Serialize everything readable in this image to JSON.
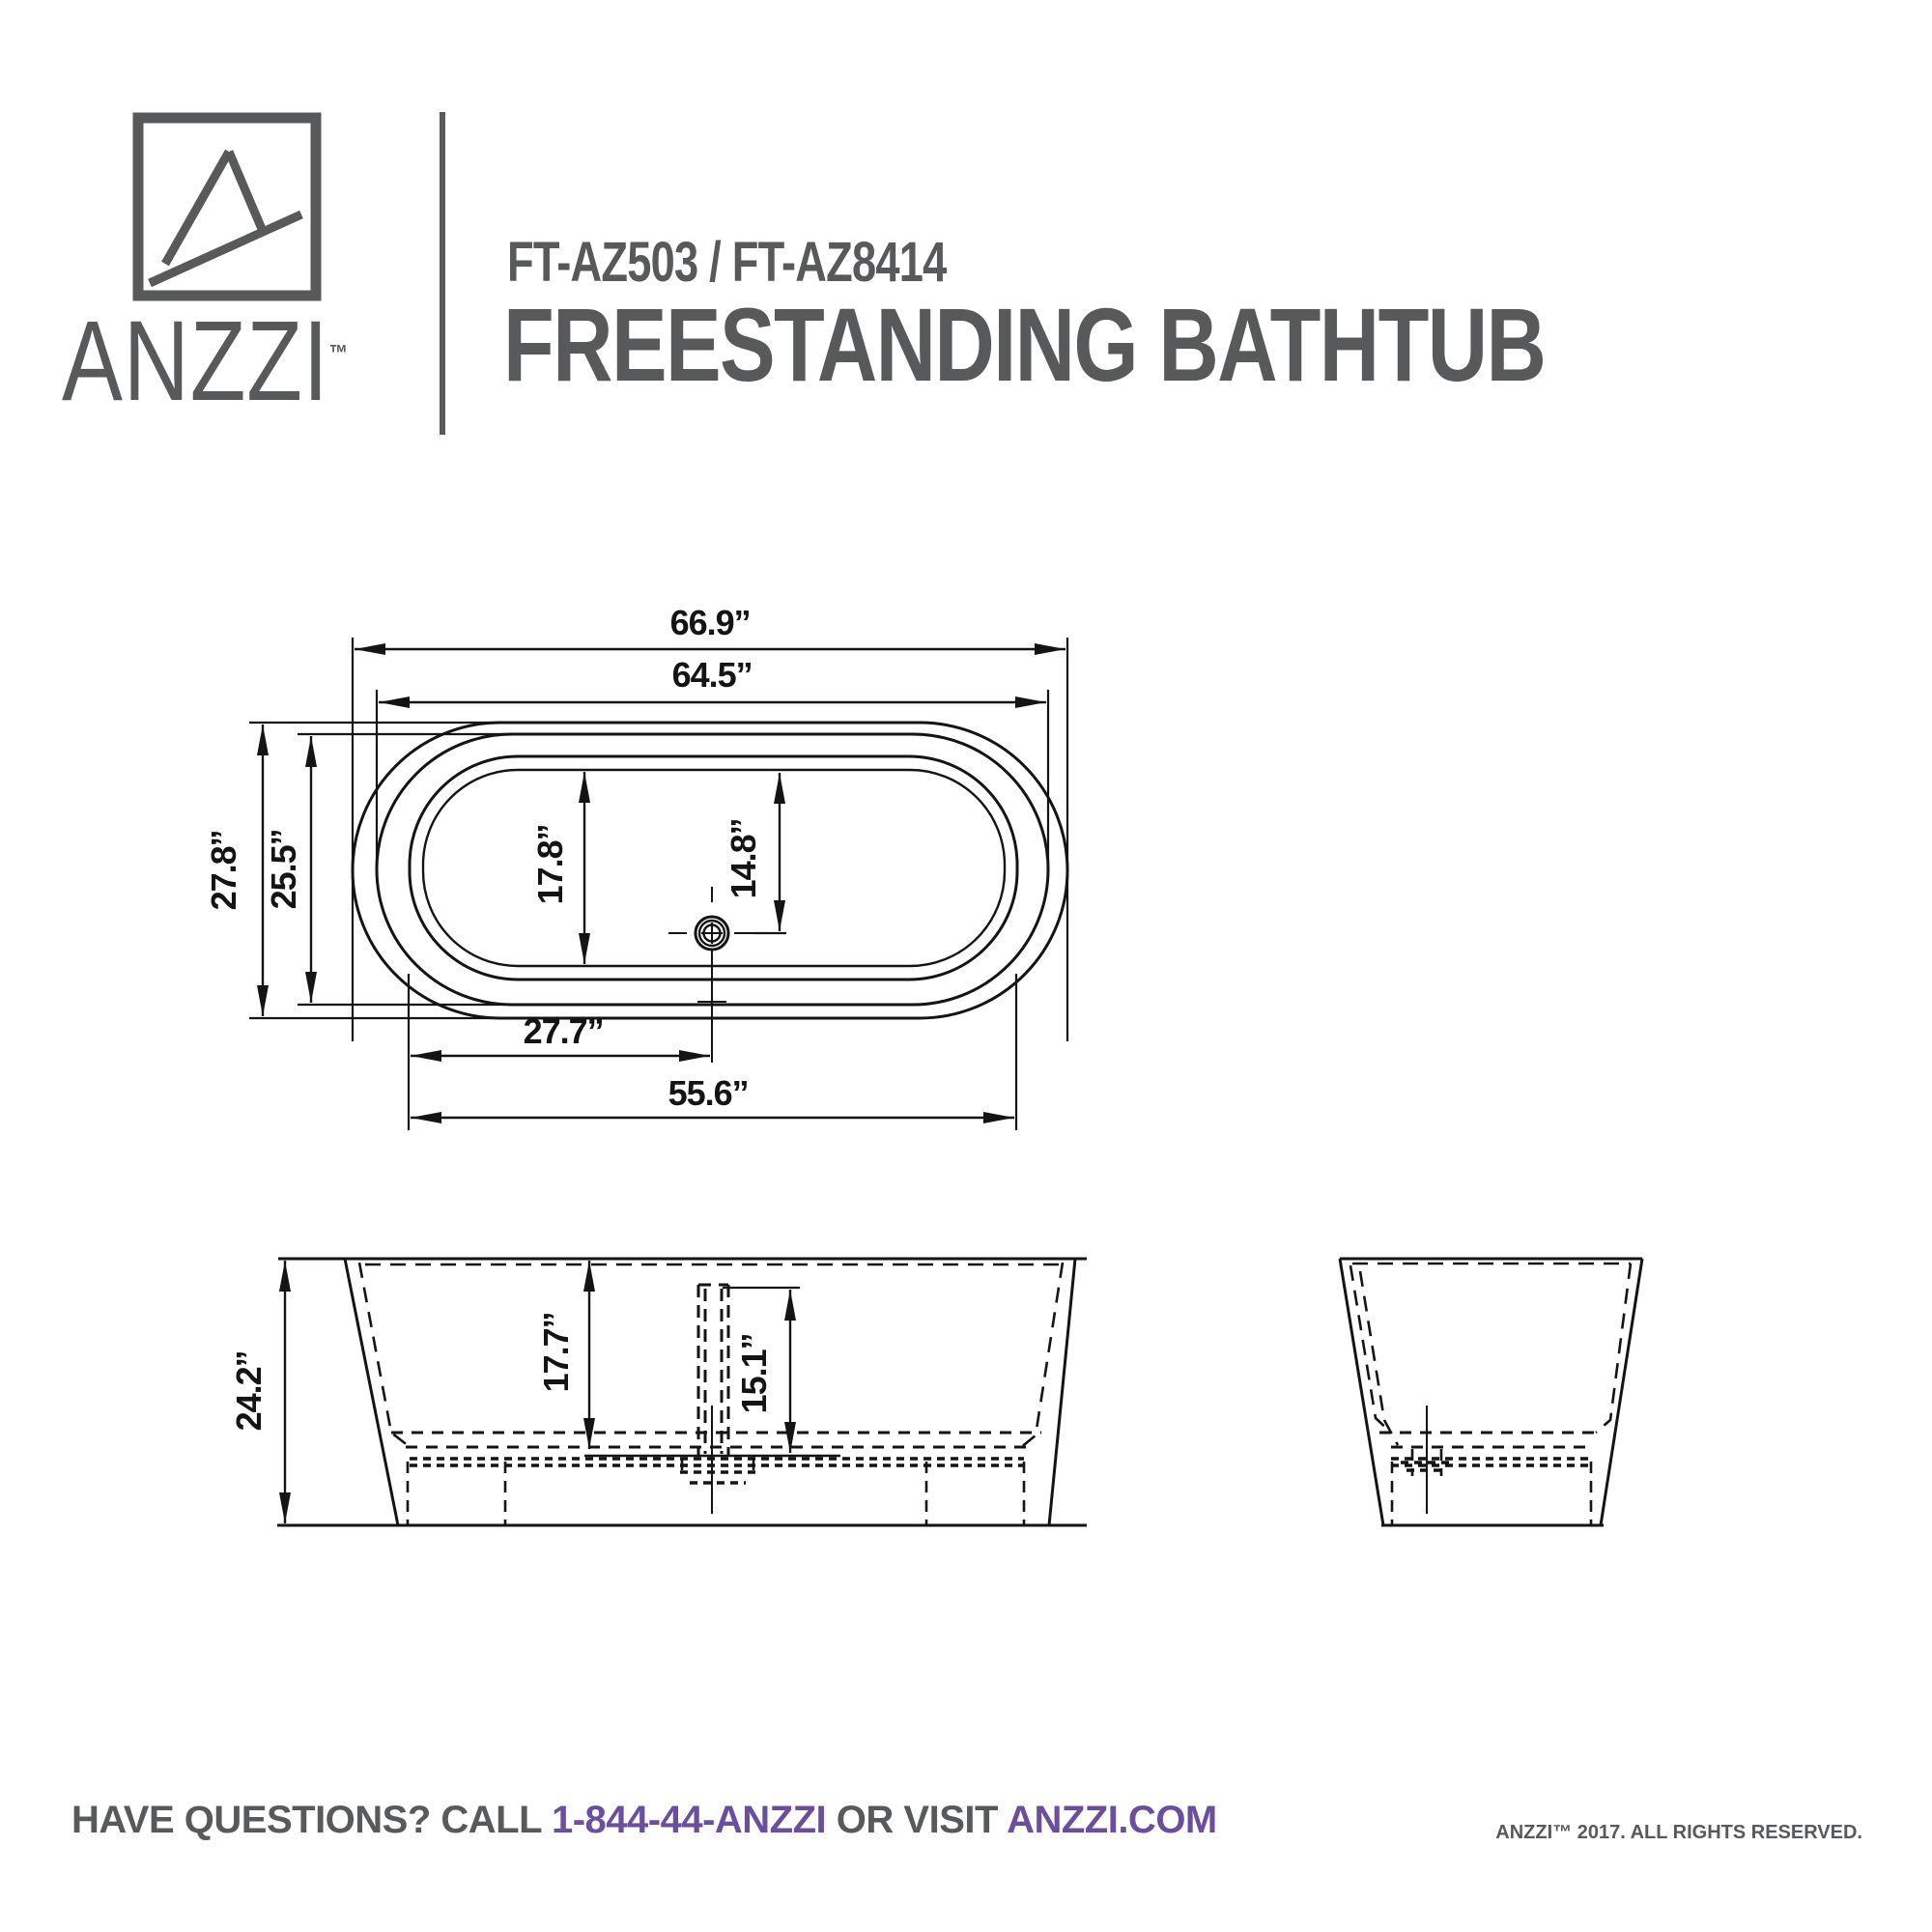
{
  "header": {
    "brand": "ANZZI",
    "brand_tm": "™",
    "model": "FT-AZ503 / FT-AZ8414",
    "product": "FREESTANDING BATHTUB"
  },
  "top_view": {
    "dims": {
      "overall_length": "66.9’’",
      "rim_length": "64.5’’",
      "overall_width": "27.8’’",
      "rim_width": "25.5’’",
      "basin_width": "17.8’’",
      "drain_offset_width": "14.8’’",
      "drain_from_end": "27.7’’",
      "basin_length": "55.6’’"
    }
  },
  "front_view": {
    "dims": {
      "overall_height": "24.2’’",
      "interior_depth": "17.7’’",
      "drain_depth": "15.1’’"
    }
  },
  "footer": {
    "question_prefix": "HAVE QUESTIONS? CALL",
    "phone": "1-844-44-ANZZI",
    "middle": "OR VISIT",
    "site": "ANZZI.COM",
    "copyright": "ANZZI™ 2017. ALL RIGHTS RESERVED."
  },
  "colors": {
    "brand_gray": "#58595B",
    "accent_purple": "#6B4F9E",
    "line": "#141414"
  }
}
